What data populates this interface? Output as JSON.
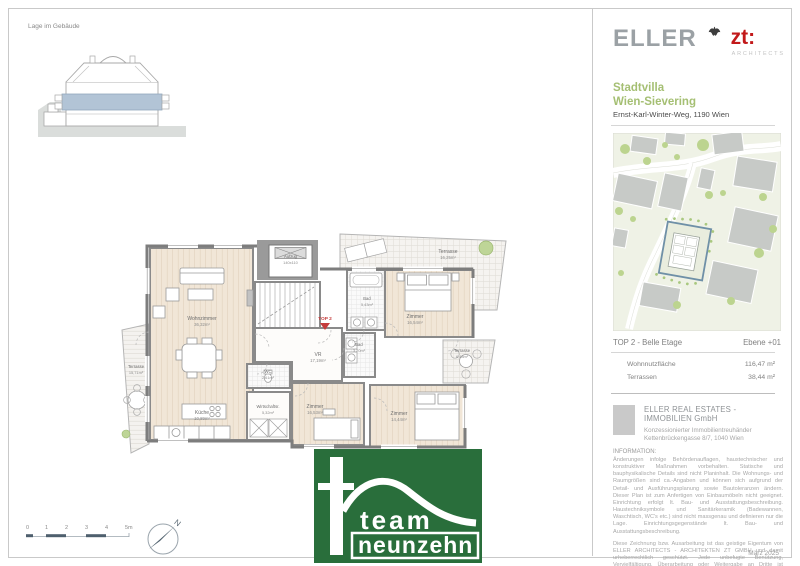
{
  "page": {
    "location_label": "Lage im Gebäude",
    "date": "März 2025"
  },
  "header": {
    "brand": "ELLER",
    "brand_suffix": "zt:",
    "brand_sub": "ARCHITECTS",
    "title_line1": "Stadtvilla",
    "title_line2": "Wien-Sievering",
    "address": "Ernst-Karl-Winter-Weg, 1190 Wien"
  },
  "map": {
    "caption_left": "TOP 2 - Belle Etage",
    "caption_right": "Ebene +01"
  },
  "areas": {
    "rows": [
      {
        "label": "Wohnnutzfläche",
        "value": "116,47 m²"
      },
      {
        "label": "Terrassen",
        "value": "38,44 m²"
      }
    ]
  },
  "company": {
    "name": "ELLER REAL ESTATES - IMMOBILIEN GmbH",
    "line1": "Konzessionierter Immobilientreuhänder",
    "line2": "Kettenbrückengasse 8/7, 1040 Wien"
  },
  "information": {
    "heading": "INFORMATION:",
    "paragraph1": "Änderungen infolge Behördenauflagen, haustechnischer und konstruktiver Maßnahmen vorbehalten. Statische und bauphysikalische Details sind nicht Planinhalt. Die Wohnungs- und Raumgrößen sind ca.-Angaben und können sich aufgrund der Detail- und Ausführungsplanung sowie Bautoleranzen ändern. Dieser Plan ist zum Anfertigen von Einbaumöbeln nicht geeignet. Einrichtung erfolgt lt. Bau- und Ausstattungsbeschreibung. Haustechniksymbole und Sanitärkeramik (Badewannen, Waschtisch, WC's etc.) sind nicht massgenau und definieren nur die Lage. Einrichtungsgegenstände lt. Bau- und Ausstattungsbeschreibung.",
    "paragraph2": "Diese Zeichnung bzw. Ausarbeitung ist das geistige Eigentum von ELLER ARCHITECTS - ARCHITEKTEN ZT GMBH und damit urheberrechtlich geschützt. Jede unbefugte Benützung, Vervielfältigung, Überarbeitung oder Weitergabe an Dritte ist verboten, strafbar und verpflichtet zum Schadenersatz (Urheberrechtsgesetz BGBL. NR. 111/1936, 206/1949, 106/1953)."
  },
  "floorplan": {
    "unit_label": "TOP 2",
    "elevator": {
      "name": "Aufzug",
      "size": "140x110"
    },
    "rooms": [
      {
        "name": "Wohnzimmer",
        "area": "36,32m²"
      },
      {
        "name": "Küche",
        "area": "10,89m²"
      },
      {
        "name": "Terrasse",
        "area": "15,71m²"
      },
      {
        "name": "WC",
        "area": "2,61m²"
      },
      {
        "name": "Wirtschaftsr.",
        "area": "5,32m²"
      },
      {
        "name": "VR",
        "area": "17,19m²"
      },
      {
        "name": "Bad",
        "area": "5,43m²"
      },
      {
        "name": "Bad",
        "area": "3,20m²"
      },
      {
        "name": "Zimmer",
        "area": "16,54m²"
      },
      {
        "name": "Terrasse",
        "area": "16,25m²"
      },
      {
        "name": "Terrasse",
        "area": "6,48m²"
      },
      {
        "name": "Zimmer",
        "area": "16,53m²"
      },
      {
        "name": "Zimmer",
        "area": "14,44m²"
      }
    ]
  },
  "scalebar": {
    "ticks": [
      "0",
      "1",
      "2",
      "3",
      "4",
      "5m"
    ]
  },
  "compass": {
    "label": "N"
  },
  "footer_logo": {
    "line1": "team",
    "line2": "neunzehn"
  },
  "colors": {
    "brand_red": "#c2191a",
    "brand_gray": "#9ba1a5",
    "title_green": "#a5bf73",
    "team_green": "#296e3b",
    "floor_highlight_blue": "#b2c4d6",
    "marker_red": "#c43c3c",
    "wall_gray": "#7d7d7d"
  }
}
